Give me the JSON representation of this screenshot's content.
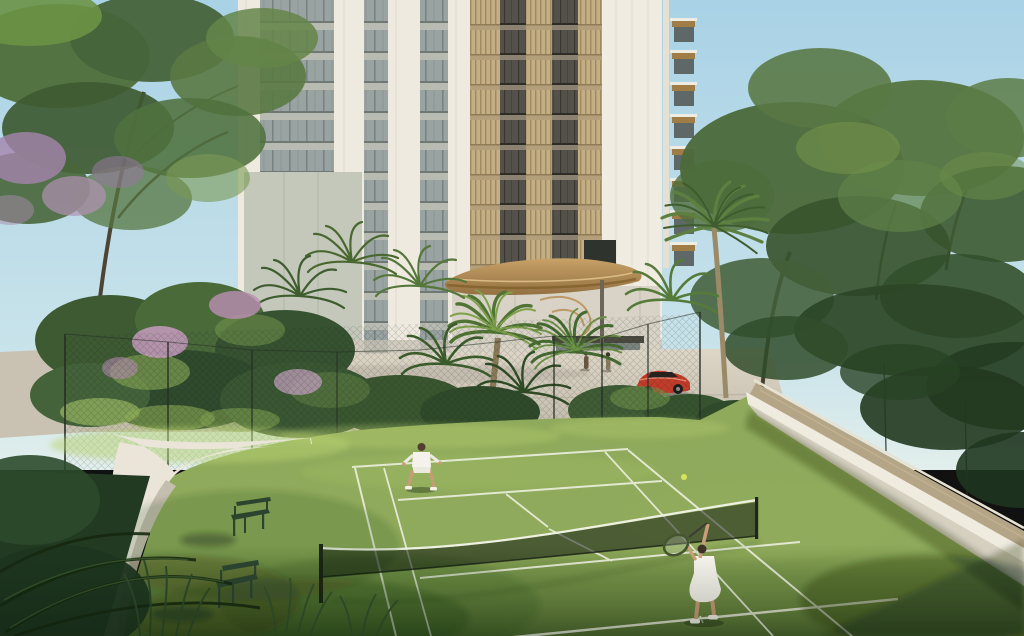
{
  "meta": {
    "kind": "architectural-rendering",
    "description": "Residential tower with sculpted timber entrance canopy behind a lawn tennis court; two players mid-rally, red sports car at the drop-off, tropical landscaping with purple-flowering trees, curved white garden walls, sand-coloured walkway, two green garden benches.",
    "width_px": 1024,
    "height_px": 636
  },
  "scene": {
    "sky": {
      "condition": "clear day",
      "top_color": "#a9d2e6",
      "horizon_color": "#e2efec"
    },
    "building": {
      "type": "residential high-rise tower",
      "facade": "white piers, grey glazed curtain-wall bands, beige vertical louvers, dark glass recesses",
      "entrance": "organic sculpted timber canopy over glazed lobby with gold swirl artwork",
      "side_wing": "stacked balconies with timber soffits on right edge"
    },
    "vehicle": {
      "type": "sports car",
      "color_name": "red",
      "location": "entrance driveway"
    },
    "people": [
      {
        "role": "tennis-player",
        "position": "far mid-court",
        "outfit": "white shirt and shorts"
      },
      {
        "role": "tennis-player-serving",
        "position": "near court, right side",
        "outfit": "white dress, racket raised"
      },
      {
        "role": "pedestrian",
        "position": "entrance plaza left"
      },
      {
        "role": "pedestrian",
        "position": "entrance plaza right"
      }
    ],
    "tennis_court": {
      "surface": "grass",
      "line_color_name": "white",
      "net": "dark mesh with white top cable, two dark posts",
      "ball": {
        "visible": true,
        "in_air": true
      }
    },
    "furniture": {
      "benches": {
        "count": 2,
        "style": "green metal garden bench",
        "location": "left lawn"
      }
    },
    "landscape": {
      "trees": "mixed tropical canopy, fan palms, tall palm by entrance",
      "blossoms": "purple-pink flowering shrubs on left",
      "walls": "curved white retaining walls around lawn",
      "walkway": "sand-tan path on raised planter wall, right side",
      "fence": "thin dark court fence posts with faint mesh",
      "foreground": "dark ornamental grasses and palm fronds, bottom left"
    }
  },
  "palette": {
    "sky_top": "#a9d2e6",
    "sky_horizon": "#e2efec",
    "building_white": "#efeae0",
    "building_white_bright": "#f1ece2",
    "glass_grey": "#99a3a2",
    "louver_beige": "#c3ae86",
    "dark_glass": "#54514a",
    "canopy_wood": "#b38a52",
    "wall_white": "#eae5d8",
    "path_tan": "#b5a587",
    "plaza_concrete": "#d6cfc0",
    "lawn_green": "#6f8c44",
    "court_line": "#eef1e2",
    "net_mesh": "rgba(16,22,15,0.52)",
    "fence_dark": "#272e26",
    "bench_green": "#2b4430",
    "car_red": "#c23c2a",
    "ball_yellow": "#d6e35c",
    "player_white": "#f4f2ea",
    "foliage_dark": "#2b4526",
    "foliage_mid": "#4c6a3b",
    "foliage_light": "#76964d",
    "blossom_purple": "#b291b4",
    "trunk_brown": "#4d4434",
    "skin_tan": "#c99c78"
  }
}
